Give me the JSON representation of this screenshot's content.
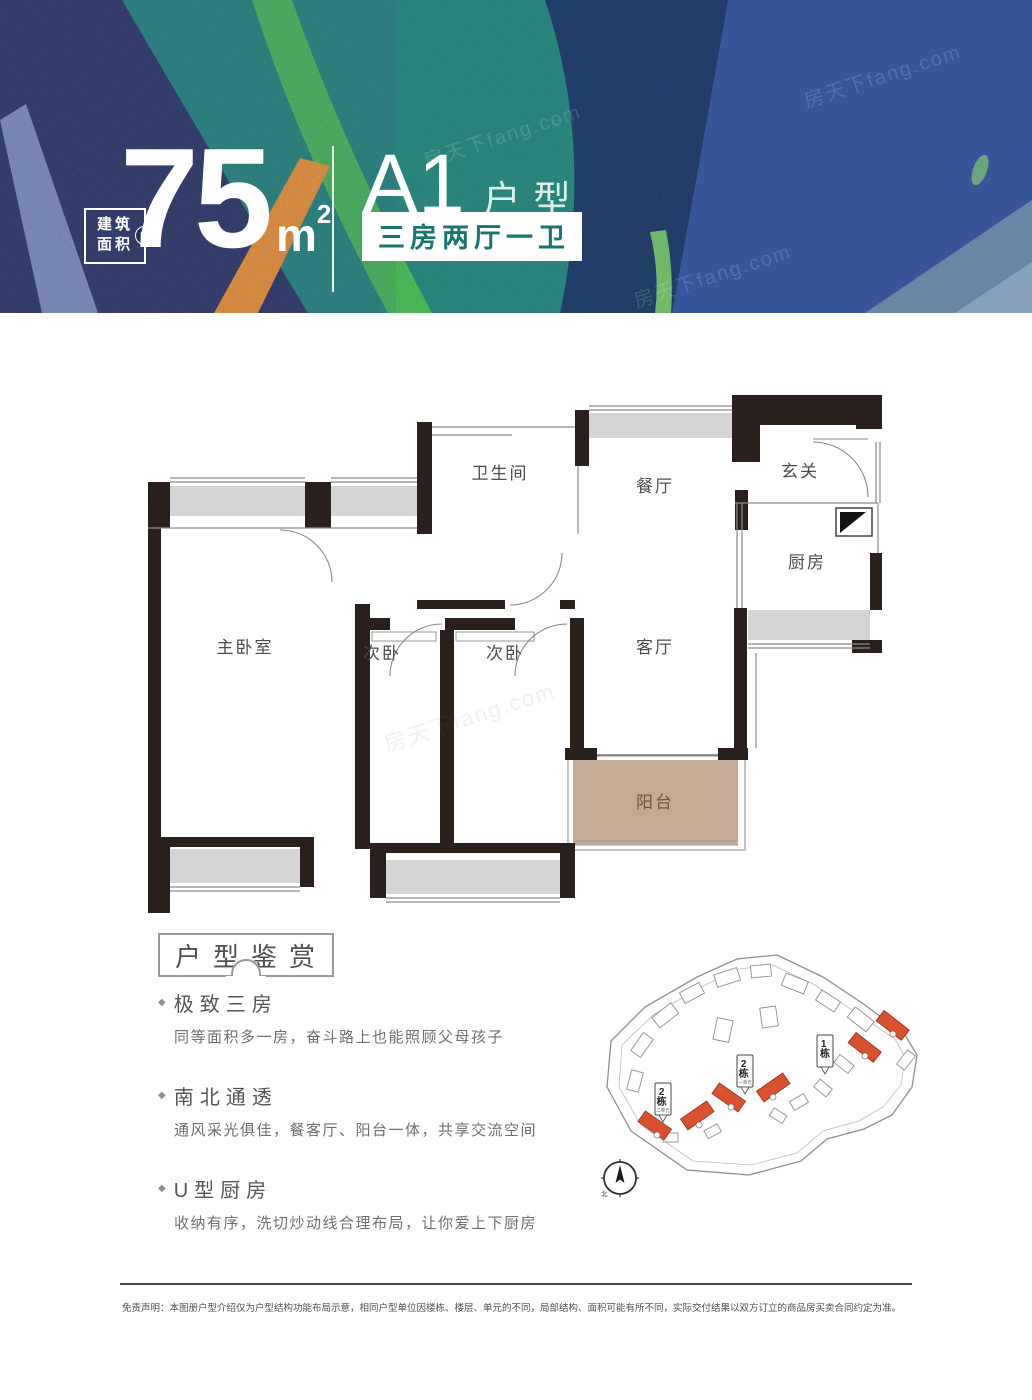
{
  "banner": {
    "badge": {
      "line1": "建筑",
      "line2": "面积",
      "approx": "约"
    },
    "area": {
      "value": "75",
      "unit": "m",
      "sup": "2"
    },
    "plan": {
      "code": "A1",
      "suffix": "户型",
      "tag": "三房两厅一卫"
    },
    "colors": {
      "teal": "#1e7d75",
      "navy": "#262e5e",
      "royal": "#2d4c94",
      "green": "#41b04d",
      "orange": "#e98a2b",
      "dark_streak": "#16335f"
    }
  },
  "watermark": "房天下fang.com",
  "floor_plan": {
    "rooms": [
      {
        "name": "卫生间"
      },
      {
        "name": "餐厅"
      },
      {
        "name": "玄关"
      },
      {
        "name": "厨房"
      },
      {
        "name": "主卧室"
      },
      {
        "name": "次卧"
      },
      {
        "name": "次卧"
      },
      {
        "name": "客厅"
      },
      {
        "name": "阳台"
      }
    ],
    "colors": {
      "wall": "#29201d",
      "window": "#d5d5d5",
      "balcony_fill": "#c4ab93",
      "balcony_text": "#6b5740"
    }
  },
  "appreciation": {
    "title": "户型鉴赏",
    "features": [
      {
        "heading": "极致三房",
        "body": "同等面积多一房，奋斗路上也能照顾父母孩子"
      },
      {
        "heading": "南北通透",
        "body": "通风采光俱佳，餐客厅、阳台一体，共享交流空间"
      },
      {
        "heading": "U型厨房",
        "body": "收纳有序，洗切炒动线合理布局，让你爱上下厨房"
      }
    ]
  },
  "site_plan": {
    "labels": [
      {
        "num": "1",
        "suffix": "栋",
        "sub": ""
      },
      {
        "num": "2",
        "suffix": "栋",
        "sub": "一单元"
      },
      {
        "num": "2",
        "suffix": "栋",
        "sub": "二单元"
      }
    ],
    "compass": "北",
    "highlight_color": "#d8502e"
  },
  "footer": {
    "disclaimer": "免责声明：本图册户型介绍仅为户型结构功能布局示意，相同户型单位因楼栋、楼层、单元的不同，局部结构、面积可能有所不同，实际交付结果以双方订立的商品房买卖合同约定为准。"
  }
}
